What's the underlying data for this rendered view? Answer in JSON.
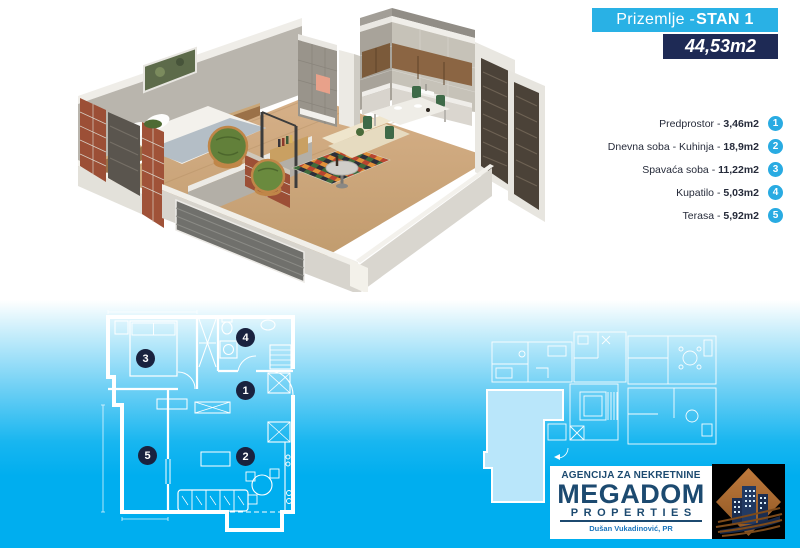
{
  "header": {
    "floor_label": "Prizemlje - ",
    "unit_label": "STAN 1",
    "total_area": "44,53m2"
  },
  "list": {
    "separator": " - "
  },
  "rooms": [
    {
      "num": "1",
      "name": "Predprostor",
      "area": "3,46m2"
    },
    {
      "num": "2",
      "name": "Dnevna soba - Kuhinja",
      "area": "18,9m2"
    },
    {
      "num": "3",
      "name": "Spavaća soba",
      "area": "11,22m2"
    },
    {
      "num": "4",
      "name": "Kupatilo",
      "area": "5,03m2"
    },
    {
      "num": "5",
      "name": "Terasa",
      "area": "5,92m2"
    }
  ],
  "plan": {
    "markers": [
      "3",
      "4",
      "1",
      "5",
      "2"
    ]
  },
  "logo": {
    "agency_line": "AGENCIJA ZA NEKRETNINE",
    "brand": "MEGADOM",
    "subbrand": "PROPERTIES",
    "registrant_line": "Dušan Vukadinović, PR"
  },
  "colors": {
    "accent_cyan": "#29abe2",
    "navy": "#1e2a55",
    "background_blue": "#00aeef",
    "logo_navy": "#1c4a70",
    "plan_highlight": "#b9e6fa"
  }
}
